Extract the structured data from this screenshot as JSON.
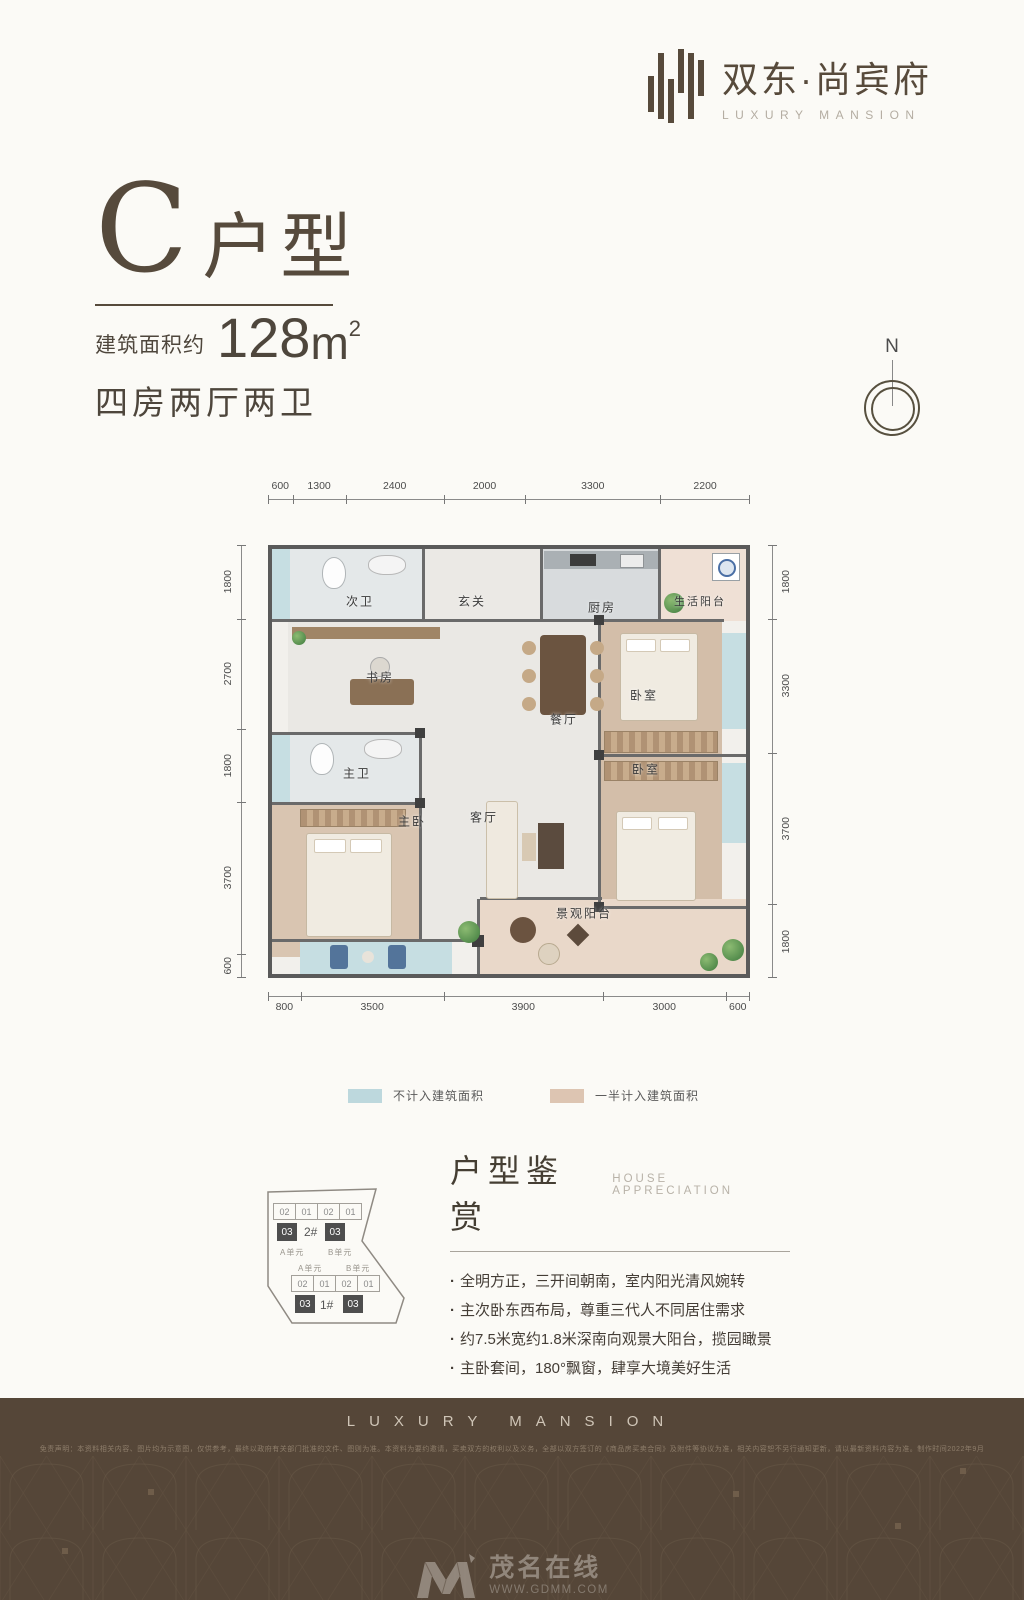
{
  "logo": {
    "cn": "双东·尚宾府",
    "en": "LUXURY MANSION"
  },
  "title": {
    "letter": "C",
    "suffix": "户型",
    "area_label": "建筑面积约",
    "area_number": "128",
    "area_unit": "m",
    "area_exp": "2",
    "rooms_label": "四房两厅两卫"
  },
  "compass": {
    "north": "N"
  },
  "floorplan": {
    "dims_top": [
      "600",
      "1300",
      "2400",
      "2000",
      "3300",
      "2200"
    ],
    "dims_left": [
      "1800",
      "2700",
      "1800",
      "3700",
      "600"
    ],
    "dims_right": [
      "1800",
      "3300",
      "3700",
      "1800"
    ],
    "dims_bottom": [
      "800",
      "3500",
      "3900",
      "3000",
      "600"
    ],
    "rooms": {
      "ciwei": "次卫",
      "xuanguan": "玄关",
      "chufang": "厨房",
      "shenghuoyangtai": "生活阳台",
      "shufang": "书房",
      "canting": "餐厅",
      "woshi1": "卧室",
      "zhuwei": "主卫",
      "zhuwo": "主卧",
      "keting": "客厅",
      "woshi2": "卧室",
      "jingguanyangtai": "景观阳台"
    }
  },
  "legend": {
    "item1": {
      "label": "不计入建筑面积",
      "color": "#bdd8dd"
    },
    "item2": {
      "label": "一半计入建筑面积",
      "color": "#ddc5b2"
    }
  },
  "sitemap": {
    "b2": {
      "name": "2#",
      "cells": [
        "02",
        "01",
        "02",
        "01"
      ],
      "hl": "03",
      "unit_a": "A单元",
      "unit_b": "B单元"
    },
    "b1": {
      "name": "1#",
      "cells": [
        "02",
        "01",
        "02",
        "01"
      ],
      "hl": "03",
      "unit_a": "A单元",
      "unit_b": "B单元"
    }
  },
  "appreciation": {
    "title_cn": "户型鉴赏",
    "title_en": "HOUSE APPRECIATION",
    "bullets": [
      "全明方正，三开间朝南，室内阳光清风婉转",
      "主次卧东西布局，尊重三代人不同居住需求",
      "约7.5米宽约1.8米深南向观景大阳台，揽园瞰景",
      "主卧套间，180°飘窗，肆享大境美好生活"
    ]
  },
  "footer": {
    "brand": "LUXURY MANSION",
    "disclaimer": "免责声明：本资料相关内容、图片均为示意图，仅供参考，最终以政府有关部门批准的文件、图则为准。本资料为要约邀请，买卖双方的权利以及义务，全部以双方签订的《商品房买卖合同》及附件等协议为准，相关内容恕不另行通知更新，请以最新资料内容为准。制作时间2022年9月",
    "watermark_cn": "茂名在线",
    "watermark_en": "WWW.GDMM.COM"
  }
}
